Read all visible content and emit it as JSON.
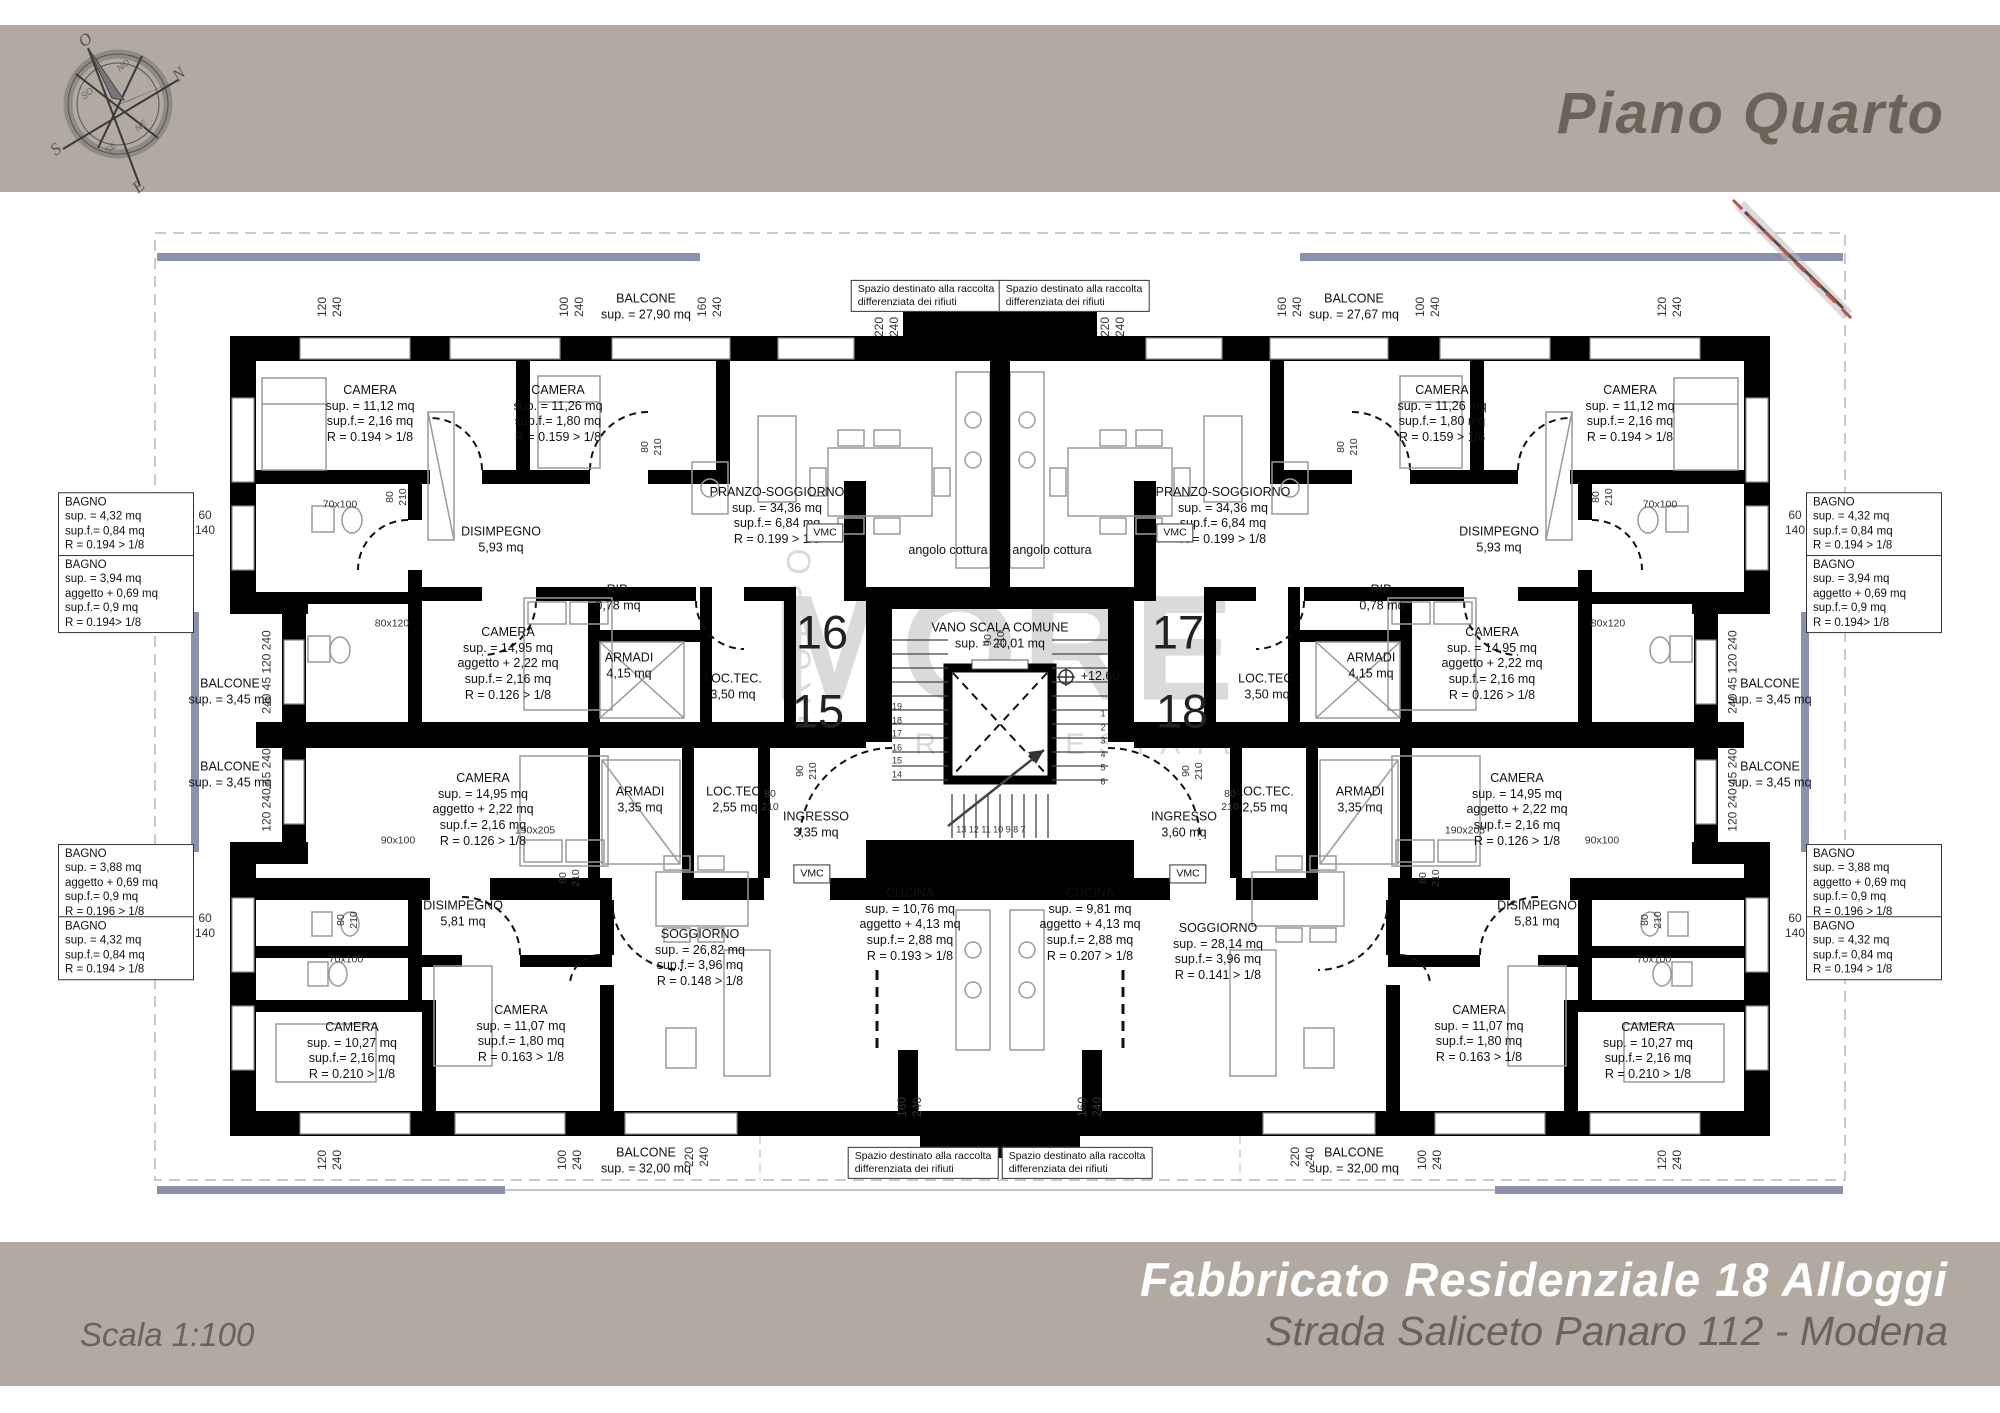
{
  "header": {
    "title": "Piano Quarto"
  },
  "footer": {
    "scale": "Scala 1:100",
    "building": "Fabbricato Residenziale 18 Alloggi",
    "address": "Strada Saliceto Panaro 112 - Modena"
  },
  "compass": {
    "n": "N",
    "s": "S",
    "e": "E",
    "o": "O",
    "no": "NO",
    "ne": "NE",
    "so": "SO",
    "se": "SE"
  },
  "watermark": {
    "gruppo": "GRUPPO",
    "name": "MORE",
    "tagline": "REAL ESTATE"
  },
  "units": {
    "u15": "15",
    "u16": "16",
    "u17": "17",
    "u18": "18"
  },
  "rooms": {
    "balcone2790": "BALCONE\nsup. = 27,90 mq",
    "balcone2767": "BALCONE\nsup. = 27,67 mq",
    "balcone3200": "BALCONE\nsup. = 32,00 mq",
    "balcone345": "BALCONE\nsup. = 3,45 mq",
    "camera1112": "CAMERA\nsup. = 11,12 mq\nsup.f.= 2,16 mq\nR = 0.194 > 1/8",
    "camera1126": "CAMERA\nsup. = 11,26 mq\nsup.f.= 1,80 mq\nR = 0.159 > 1/8",
    "camera1495": "CAMERA\nsup. = 14,95 mq\naggetto + 2,22 mq\nsup.f.= 2,16 mq\nR = 0.126 > 1/8",
    "camera1027": "CAMERA\nsup. = 10,27 mq\nsup.f.= 2,16 mq\nR = 0.210 > 1/8",
    "camera1107": "CAMERA\nsup. = 11,07 mq\nsup.f.= 1,80 mq\nR = 0.163 > 1/8",
    "disimpegno593": "DISIMPEGNO\n5,93 mq",
    "disimpegno581": "DISIMPEGNO\n5,81 mq",
    "pranzo": "PRANZO-SOGGIORNO\nsup. = 34,36 mq\nsup.f.= 6,84 mq\nR = 0.199 > 1/8",
    "soggiorno2682": "SOGGIORNO\nsup. = 26,82 mq\nsup.f.= 3,96 mq\nR = 0.148 > 1/8",
    "soggiorno2814": "SOGGIORNO\nsup. = 28,14 mq\nsup.f.= 3,96 mq\nR = 0.141 > 1/8",
    "cucina1076": "CUCINA\nsup. = 10,76 mq\naggetto + 4,13 mq\nsup.f.= 2,88 mq\nR = 0.193 > 1/8",
    "cucina981": "CUCINA\nsup. = 9,81 mq\naggetto + 4,13 mq\nsup.f.= 2,88 mq\nR = 0.207 > 1/8",
    "rip": "RIP.\n0,78 mq",
    "armadi415": "ARMADI\n4,15 mq",
    "armadi335": "ARMADI\n3,35 mq",
    "loctec350": "LOC.TEC.\n3,50 mq",
    "loctec255": "LOC.TEC.\n2,55 mq",
    "ingresso335": "INGRESSO\n3,35 mq",
    "ingresso360": "INGRESSO\n3,60 mq",
    "vano": "VANO SCALA COMUNE\nsup. = 20,01 mq",
    "bagno432": "BAGNO\nsup. = 4,32 mq\nsup.f.= 0,84 mq\nR = 0.194 > 1/8",
    "bagno394": "BAGNO\nsup. = 3,94 mq\naggetto + 0,69 mq\nsup.f.= 0,9 mq\nR = 0.194> 1/8",
    "bagno388": "BAGNO\nsup. = 3,88 mq\naggetto + 0,69 mq\nsup.f.= 0,9 mq\nR = 0.196 > 1/8"
  },
  "notes": {
    "spazio": "Spazio destinato alla raccolta\ndifferenziata dei rifiuti",
    "vmc": "VMC",
    "angolo": "angolo cottura",
    "elevation": "+12.60"
  },
  "dims": {
    "v120": "120\n240",
    "v100": "100\n240",
    "v160": "160\n240",
    "v220": "220\n240",
    "h60": "60\n140",
    "d80": "80\n210",
    "d90": "90\n210",
    "s70": "70x100",
    "s80": "80x120",
    "s90": "90x100",
    "s190": "190x205",
    "sideA": "240  45  120  240",
    "sideB": "120  240  45  240"
  },
  "stairs": {
    "left": "19\n18\n17\n16\n15\n14",
    "right": "1\n2\n3\n4\n5\n6",
    "bottom": "13   12   11   10   9   8   7"
  },
  "colors": {
    "banner": "#b2a9a1",
    "balcony_blue": "#8b90ad",
    "section_red": "#c0504d",
    "title_text": "#6b6258"
  }
}
